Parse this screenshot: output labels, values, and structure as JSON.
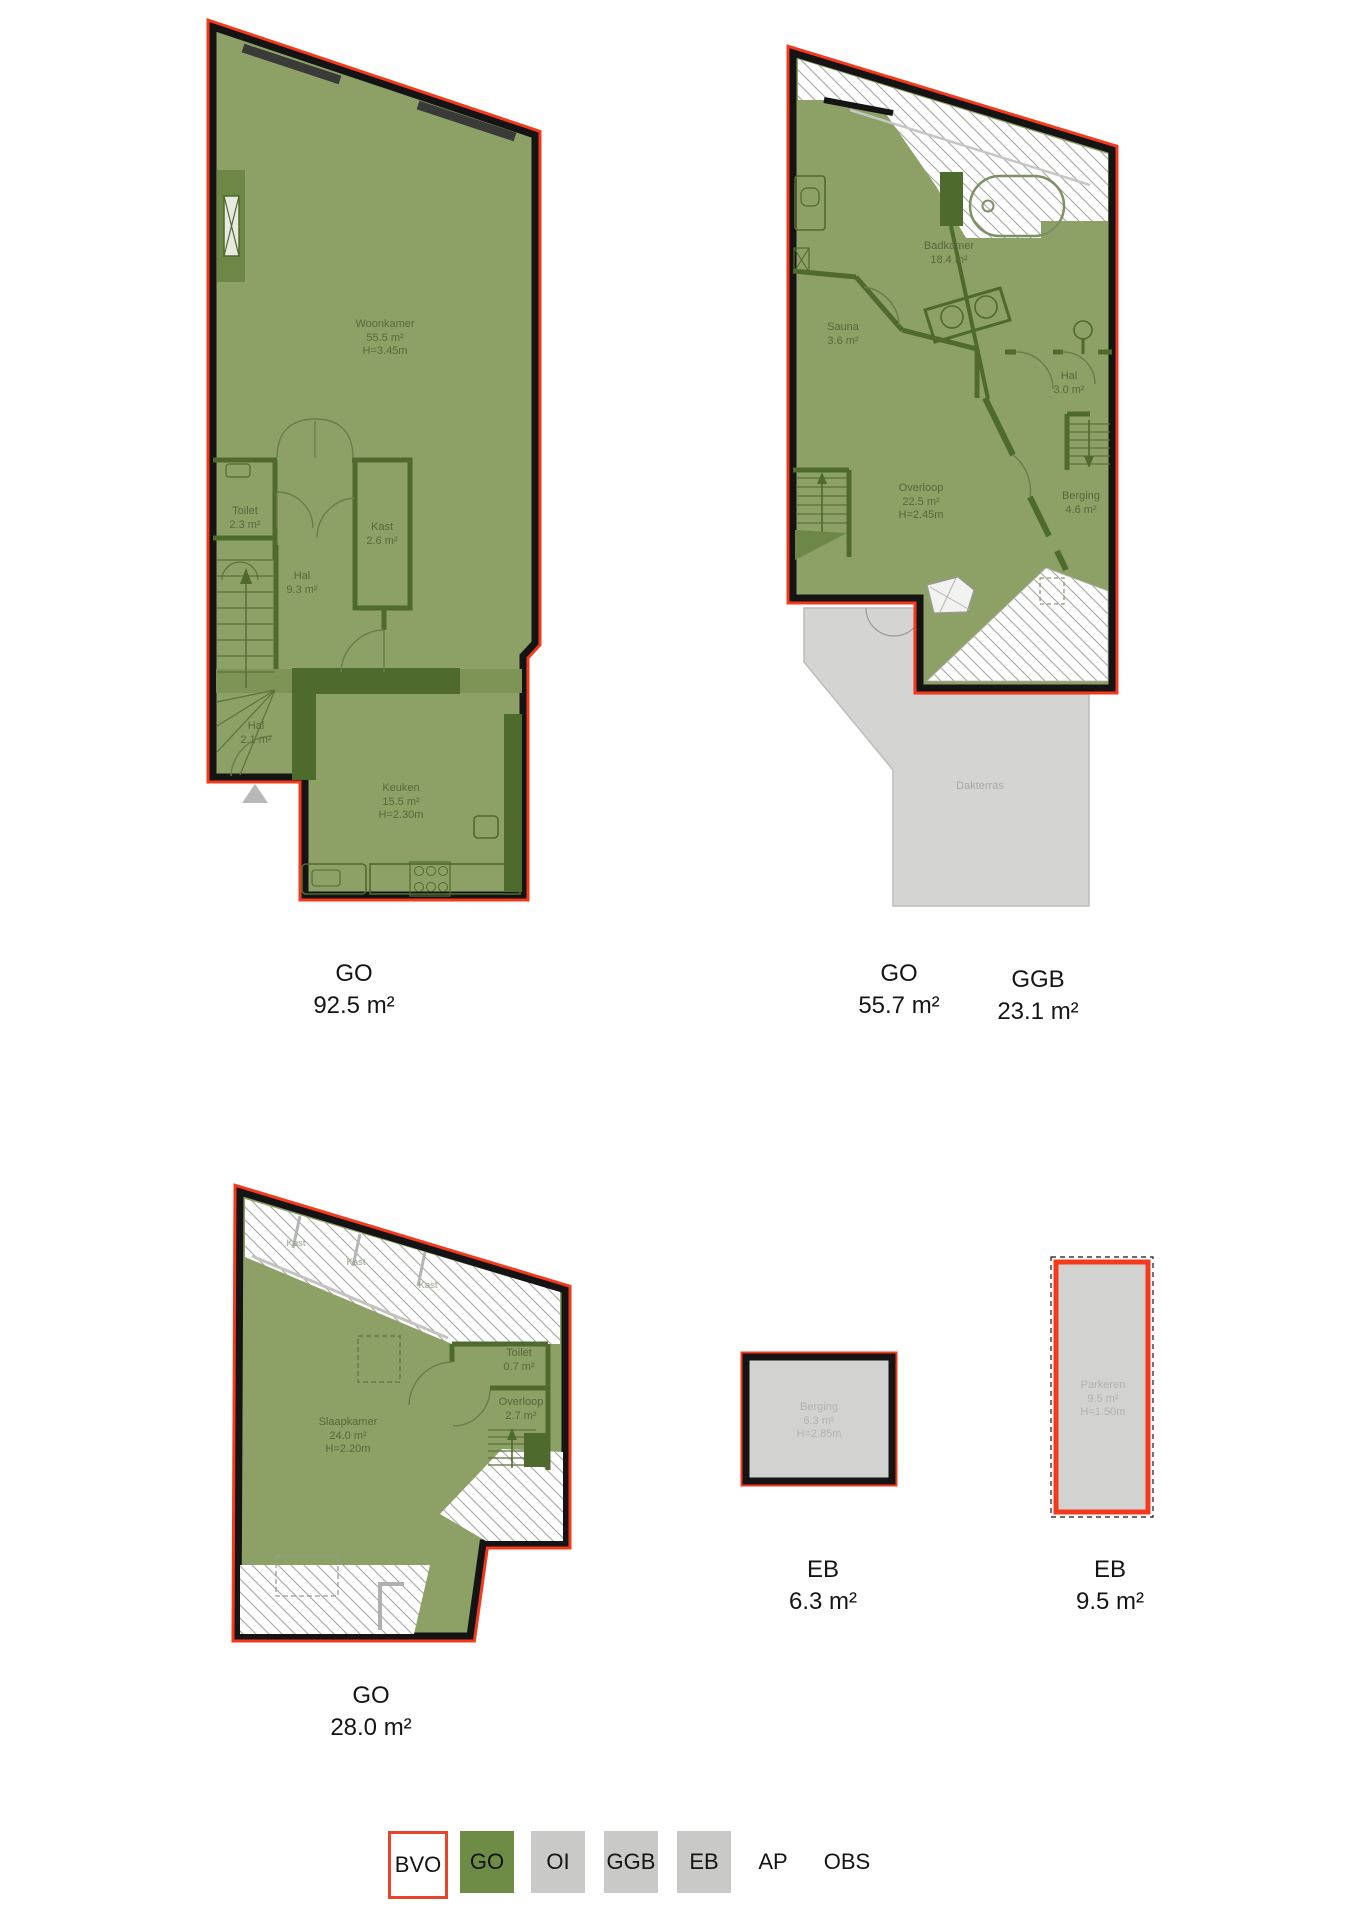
{
  "colors": {
    "bvo_outline_red": "#f5391d",
    "go_green_fill": "#8da166",
    "wall_dark_green": "#4e6a2d",
    "wall_black": "#141414",
    "ggb_eb_gray_fill": "#d2d2d0",
    "legend_go_green": "#6f8c46",
    "legend_gray": "#c9c9c7",
    "room_label_green": "#57683f",
    "room_label_gray": "#b2b2b0"
  },
  "plans": [
    {
      "caption": {
        "label": "GO",
        "value": "92.5 m²"
      },
      "rooms": [
        {
          "name": "Woonkamer",
          "area": "55.5 m²",
          "height": "H=3.45m"
        },
        {
          "name": "Toilet",
          "area": "2.3 m²"
        },
        {
          "name": "Kast",
          "area": "2.6 m²"
        },
        {
          "name": "Hal",
          "area": "9.3 m²"
        },
        {
          "name": "Hal",
          "area": "2.1 m²"
        },
        {
          "name": "Keuken",
          "area": "15.5 m²",
          "height": "H=2.30m"
        }
      ]
    },
    {
      "caption": {
        "label": "GO",
        "value": "55.7 m²"
      },
      "caption2": {
        "label": "GGB",
        "value": "23.1 m²"
      },
      "rooms": [
        {
          "name": "Badkamer",
          "area": "18.4 m²"
        },
        {
          "name": "Sauna",
          "area": "3.6 m²"
        },
        {
          "name": "Hal",
          "area": "3.0 m²"
        },
        {
          "name": "Overloop",
          "area": "22.5 m²",
          "height": "H=2.45m"
        },
        {
          "name": "Berging",
          "area": "4.6 m²"
        },
        {
          "name": "Dakterras"
        }
      ]
    },
    {
      "caption": {
        "label": "GO",
        "value": "28.0 m²"
      },
      "rooms": [
        {
          "name": "Slaapkamer",
          "area": "24.0 m²",
          "height": "H=2.20m"
        },
        {
          "name": "Toilet",
          "area": "0.7 m²"
        },
        {
          "name": "Overloop",
          "area": "2.7 m²"
        },
        {
          "name": "Kast"
        },
        {
          "name": "Kast"
        },
        {
          "name": "Kast"
        }
      ]
    },
    {
      "caption": {
        "label": "EB",
        "value": "6.3 m²"
      },
      "rooms": [
        {
          "name": "Berging",
          "area": "6.3 m²",
          "height": "H=2.85m"
        }
      ]
    },
    {
      "caption": {
        "label": "EB",
        "value": "9.5 m²"
      },
      "rooms": [
        {
          "name": "Parkeren",
          "area": "9.5 m²",
          "height": "H=1.50m"
        }
      ]
    }
  ],
  "legend": {
    "items": [
      {
        "label": "BVO",
        "swatch": "outline-red"
      },
      {
        "label": "GO",
        "swatch": "green"
      },
      {
        "label": "OI",
        "swatch": "gray"
      },
      {
        "label": "GGB",
        "swatch": "gray"
      },
      {
        "label": "EB",
        "swatch": "gray"
      },
      {
        "label": "AP",
        "swatch": "none"
      },
      {
        "label": "OBS",
        "swatch": "none"
      }
    ]
  }
}
